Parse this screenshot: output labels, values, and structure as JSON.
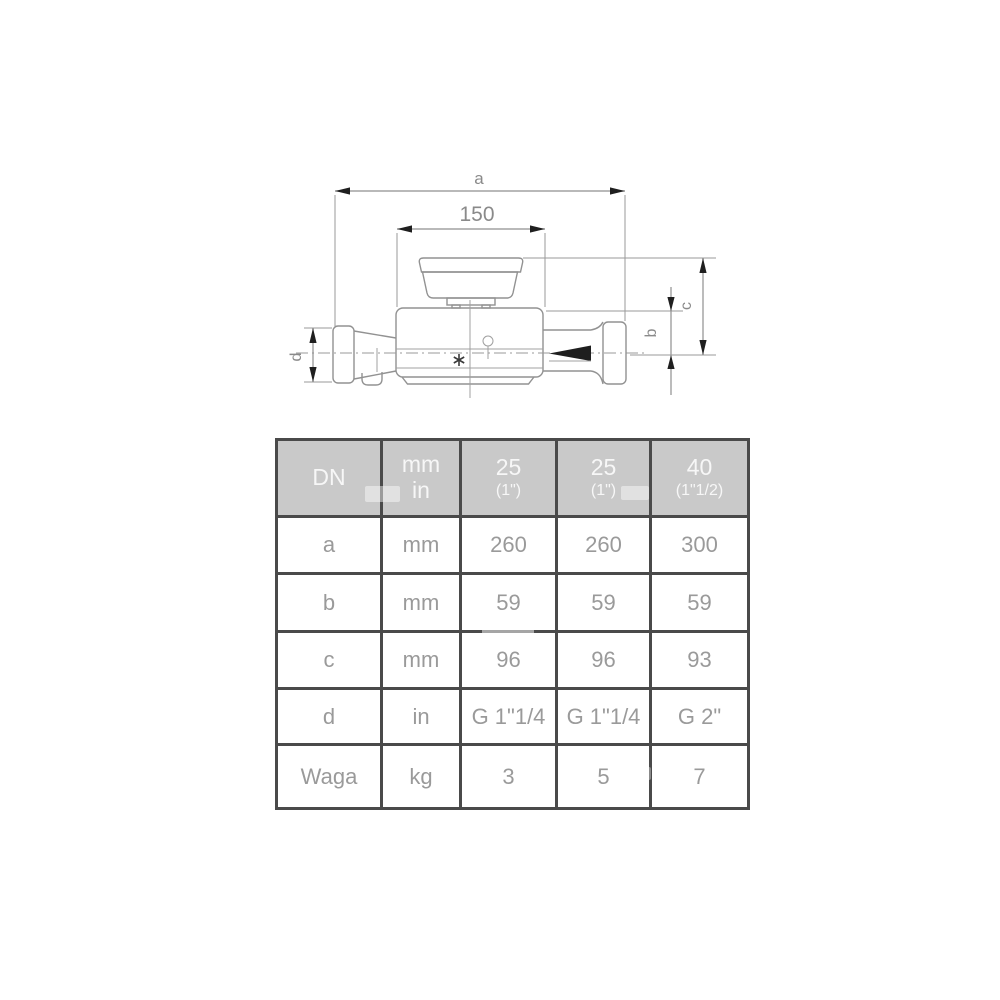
{
  "drawing": {
    "dim_overall_length": "a",
    "dim_sensor_length": "150",
    "dim_body_height": "b",
    "dim_total_height": "c",
    "dim_connection": "d"
  },
  "table": {
    "header": {
      "dn": "DN",
      "unit_top": "mm",
      "unit_bottom": "in",
      "sizes": [
        {
          "dn": "25",
          "inches": "(1\")"
        },
        {
          "dn": "25",
          "inches": "(1\")"
        },
        {
          "dn": "40",
          "inches": "(1\"1/2)"
        }
      ]
    },
    "rows": [
      {
        "label": "a",
        "unit": "mm",
        "values": [
          "260",
          "260",
          "300"
        ]
      },
      {
        "label": "b",
        "unit": "mm",
        "values": [
          "59",
          "59",
          "59"
        ]
      },
      {
        "label": "c",
        "unit": "mm",
        "values": [
          "96",
          "96",
          "93"
        ]
      },
      {
        "label": "d",
        "unit": "in",
        "values": [
          "G 1\"1/4",
          "G 1\"1/4",
          "G 2\""
        ]
      },
      {
        "label": "Waga",
        "unit": "kg",
        "values": [
          "3",
          "5",
          "7"
        ]
      }
    ]
  },
  "colors": {
    "background": "#ffffff",
    "table_header_bg": "#c9c9c9",
    "table_header_text": "#f7f7f7",
    "table_border": "#4a4a4a",
    "table_cell_text": "#9a9a9a",
    "drawing_line": "#929292",
    "dimension_arrow": "#1f1f1f",
    "dimension_text": "#8a8a8a"
  }
}
